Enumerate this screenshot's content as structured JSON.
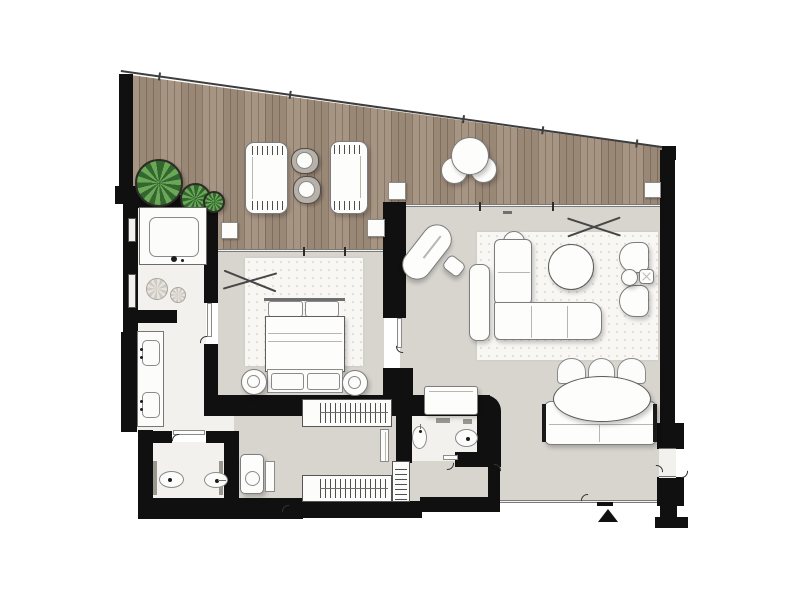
{
  "floor_plan": {
    "kind": "residential-suite-floor-plan",
    "visible_text": [],
    "colors": {
      "wall": "#101010",
      "deck_wood": "#a28f7d",
      "deck_plank_line": "#6e5c49",
      "interior_floor": "#d8d5cf",
      "wet_room_floor": "#f2f1ee",
      "rug": "#f8f7f3",
      "furniture_fill": "#fdfdfc",
      "furniture_outline": "#7d7d7d",
      "plant_dark": "#33672f",
      "plant_light": "#6aa858"
    },
    "rooms": [
      "terrace-deck",
      "bedroom",
      "living-room",
      "bathroom",
      "wc",
      "powder-room",
      "walk-in-closet",
      "entry-hall"
    ],
    "terrace": {
      "items": [
        "railing",
        "sun-lounger-left",
        "sun-lounger-right",
        "lounge-side-table-upper",
        "lounge-side-table-lower",
        "bistro-table",
        "bistro-chair-left",
        "bistro-chair-right",
        "plant-large",
        "plant-medium",
        "plant-small",
        "column-1",
        "column-2",
        "column-3",
        "column-4"
      ]
    },
    "bedroom": {
      "items": [
        "ceiling-fan",
        "area-rug",
        "double-bed",
        "headboard",
        "pillow-left",
        "pillow-right",
        "foot-bench",
        "bench-cushion-left",
        "bench-cushion-right",
        "round-stool-left",
        "round-stool-right",
        "wardrobe-hanging-rail"
      ]
    },
    "living_room": {
      "items": [
        "ceiling-fan",
        "area-rug",
        "l-shaped-sofa",
        "round-sofa-cushion",
        "sofa-back-console",
        "round-coffee-table",
        "armchair-upper",
        "armchair-lower",
        "round-side-table",
        "square-side-table",
        "chaise-longue",
        "ottoman",
        "oval-dining-table",
        "dining-chair-1",
        "dining-chair-2",
        "dining-chair-3",
        "banquette-sofa",
        "entry-console",
        "entrance-arrow"
      ]
    },
    "bathroom": {
      "items": [
        "walk-in-shower",
        "shower-tray",
        "shower-head",
        "double-vanity",
        "sink-upper",
        "sink-lower",
        "wall-niche-upper",
        "wall-niche-lower",
        "decor-plant-1",
        "decor-plant-2"
      ]
    },
    "wc": {
      "items": [
        "toilet",
        "bidet",
        "partition-left",
        "partition-right",
        "washing-machine",
        "side-cabinet"
      ]
    },
    "powder_room": {
      "items": [
        "pedestal-sink",
        "toilet",
        "cistern-mark-1",
        "cistern-mark-2"
      ]
    },
    "closet": {
      "items": [
        "wardrobe-lower-hanging-rail",
        "linen-shelf-unit",
        "mirror-panel"
      ]
    },
    "openings": [
      "sliding-door-living",
      "sliding-door-bedroom",
      "door-bathroom-bedroom",
      "door-bedroom-hall",
      "door-wc",
      "door-powder-room",
      "door-hall-living",
      "double-door-right-wall",
      "entrance-door",
      "service-door-bottom"
    ]
  }
}
